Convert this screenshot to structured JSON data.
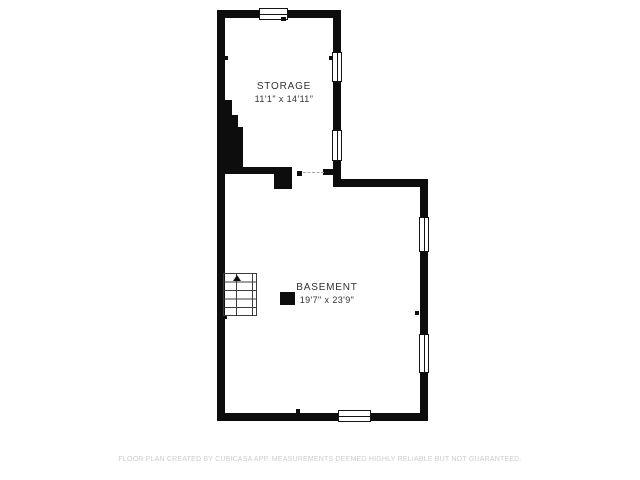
{
  "title": "Basement floor plan",
  "colors": {
    "background": "#ffffff",
    "wall": "#0d0d0d",
    "label_text": "#323232",
    "disclaimer_text": "#cccccc"
  },
  "rooms": [
    {
      "name": "STORAGE",
      "dimensions": "11'1\" x 14'11\""
    },
    {
      "name": "BASEMENT",
      "dimensions": "19'7\" x 23'9\""
    }
  ],
  "stairs": {
    "treads": 5,
    "direction_arrow": "up"
  },
  "footer": {
    "disclaimer": "FLOOR PLAN CREATED BY CUBICASA APP. MEASUREMENTS DEEMED HIGHLY RELIABLE BUT NOT GUARANTEED."
  }
}
